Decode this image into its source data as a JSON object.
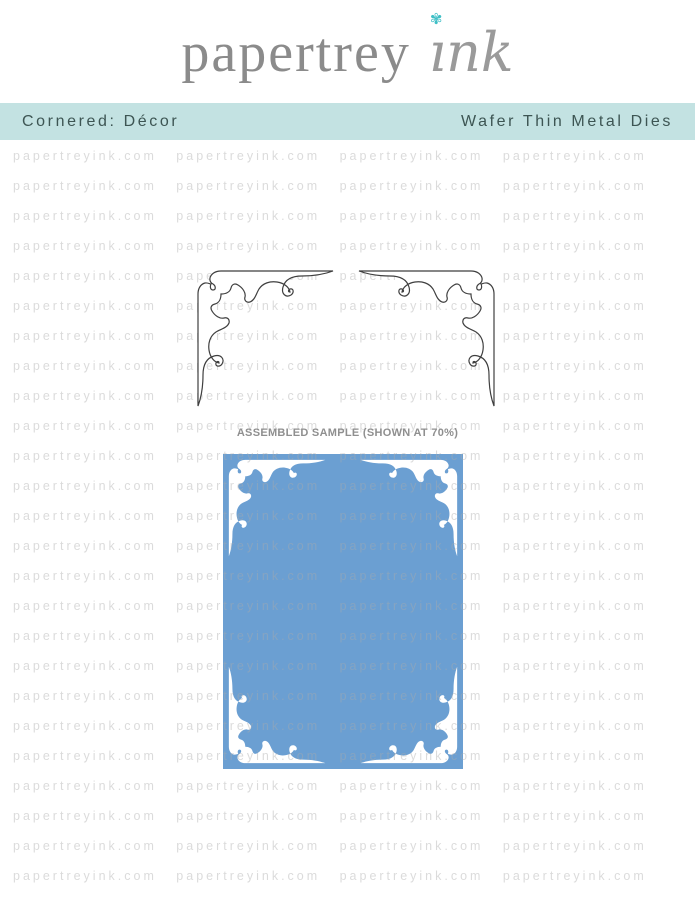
{
  "brand": {
    "word1": "papertrey",
    "word2": "ink",
    "word2_display": "ınk",
    "flower_glyph": "✾"
  },
  "banner": {
    "left_title": "Cornered: Décor",
    "right_title": "Wafer Thin Metal Dies"
  },
  "watermark": {
    "text": "papertreyink.com",
    "columns": 4,
    "rows": 26,
    "row_height_px": 30
  },
  "main": {
    "sample_label": "ASSEMBLED SAMPLE (SHOWN AT 70%)"
  },
  "colors": {
    "banner_bg": "#c3e2e2",
    "banner_text": "#3d5553",
    "card_blue": "#6b9fd2",
    "logo_gray": "#8b8b8b",
    "ink_gray": "#9a9a9a",
    "flower_teal": "#3fbfc6",
    "die_outline": "#3f3f3f",
    "label_gray": "#8f8f8f",
    "watermark_gray": "#ababab"
  }
}
